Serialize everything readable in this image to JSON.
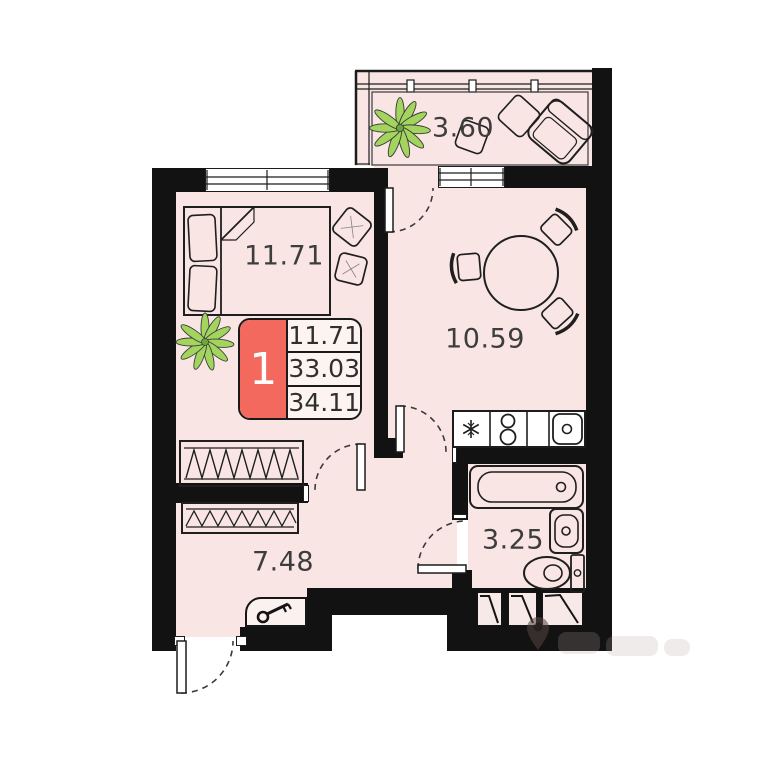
{
  "plan": {
    "info_box": {
      "unit_number": "1",
      "values": [
        "11.71",
        "33.03",
        "34.11"
      ]
    },
    "rooms": {
      "bedroom": {
        "area": "11.71"
      },
      "kitchen_living": {
        "area": "10.59"
      },
      "balcony": {
        "area": "3.60"
      },
      "hallway": {
        "area": "7.48"
      },
      "bathroom": {
        "area": "3.25"
      }
    },
    "colors": {
      "wall": "#121212",
      "room_fill": "#f9e6e4",
      "accent_red": "#f4695e",
      "plant_green": "#a2d45e",
      "line": "#1f1f1f"
    }
  }
}
